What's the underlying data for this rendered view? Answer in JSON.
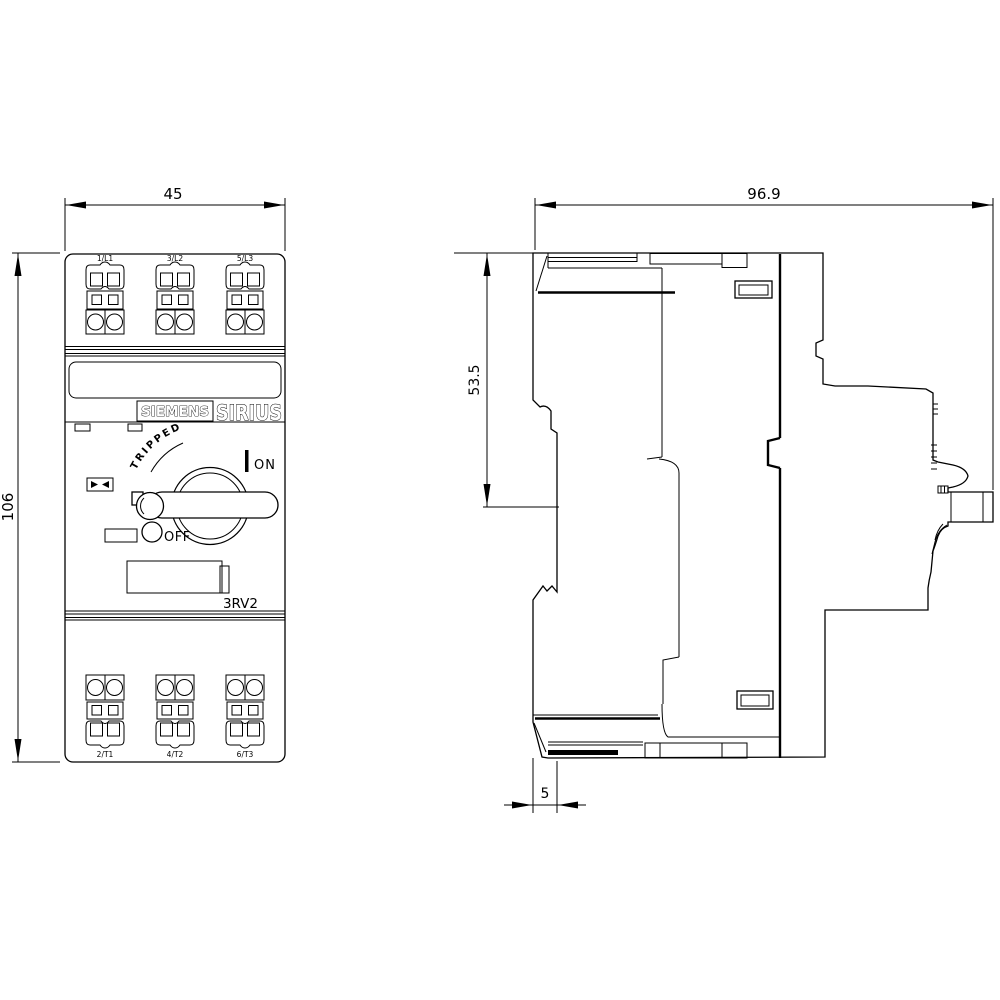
{
  "title": "SIRIUS 3RV2 motor starter protector dimensional drawing",
  "colors": {
    "line": "#000000",
    "background": "#ffffff"
  },
  "front_view": {
    "brand": "SIEMENS",
    "family": "SIRIUS",
    "series": "3RV2",
    "switch": {
      "tripped": "TRIPPED",
      "on": "ON",
      "off": "OFF"
    },
    "terminals": {
      "top": [
        "1/L1",
        "3/L2",
        "5/L3"
      ],
      "bottom": [
        "2/T1",
        "4/T2",
        "6/T3"
      ]
    },
    "dims": {
      "width": "45",
      "height": "106"
    }
  },
  "side_view": {
    "dims": {
      "depth": "96.9",
      "upper_height": "53.5",
      "rail_offset": "5"
    }
  }
}
